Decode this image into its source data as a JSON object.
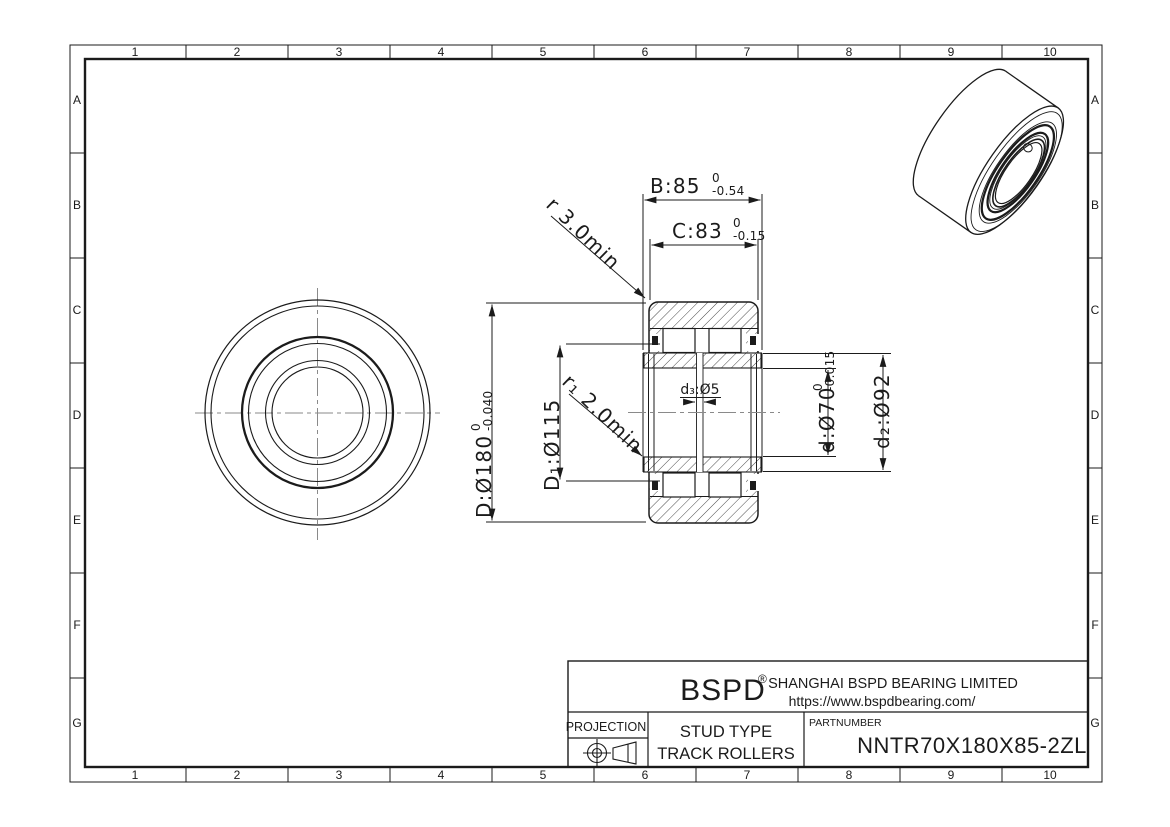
{
  "grid": {
    "cols": [
      "1",
      "2",
      "3",
      "4",
      "5",
      "6",
      "7",
      "8",
      "9",
      "10"
    ],
    "rows": [
      "A",
      "B",
      "C",
      "D",
      "E",
      "F",
      "G"
    ]
  },
  "dims": {
    "B": {
      "label": "B:85",
      "tol_top": "0",
      "tol_bottom": "-0.54"
    },
    "C": {
      "label": "C:83",
      "tol_top": "0",
      "tol_bottom": "-0.15"
    },
    "r": {
      "label": "r 3.0min"
    },
    "r1": {
      "label": "r₁ 2.0min"
    },
    "D": {
      "label": "D:Ø180",
      "tol_top": "0",
      "tol_bottom": "-0.040"
    },
    "D1": {
      "label": "D₁:Ø115"
    },
    "d": {
      "label": "d:Ø70",
      "tol_top": "0",
      "tol_bottom": "-0.015"
    },
    "d2": {
      "label": "d₂:Ø92"
    },
    "d3": {
      "label": "d₃:Ø5"
    }
  },
  "title_block": {
    "logo": "BSPD",
    "logo_reg": "®",
    "company_line1": "SHANGHAI BSPD BEARING LIMITED",
    "company_line2": "https://www.bspdbearing.com/",
    "projection_label": "PROJECTION",
    "product_line1": "STUD TYPE",
    "product_line2": "TRACK ROLLERS",
    "partnumber_label": "PARTNUMBER",
    "partnumber": "NNTR70X180X85-2ZL"
  },
  "colors": {
    "line": "#1b1b1b",
    "hatch": "#4a4a4a",
    "centerline": "#8a8a8a"
  }
}
